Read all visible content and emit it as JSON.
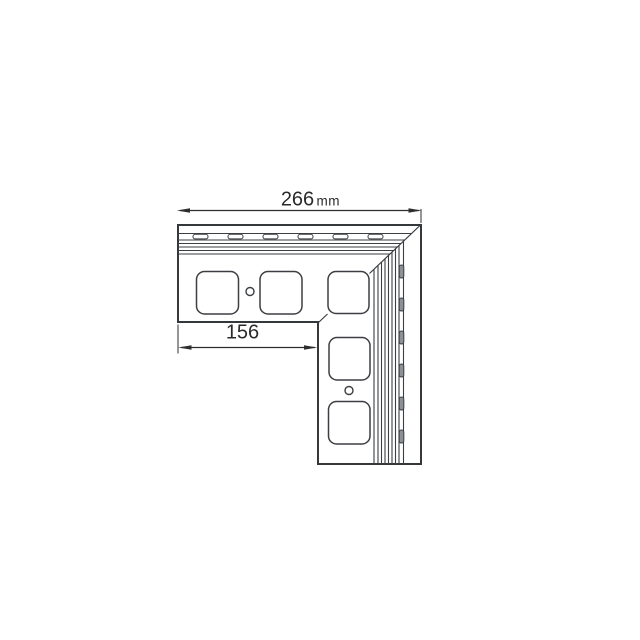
{
  "page": {
    "background_color": "#ffffff"
  },
  "drawing": {
    "type": "technical-line-drawing",
    "subject": "L-shaped corner trim profile, front view with mitre joint",
    "dimension_total": {
      "value": "266",
      "unit": "mm"
    },
    "dimension_partial": {
      "value": "156"
    },
    "colors": {
      "line": "#3b3e42",
      "outline": "#35383b",
      "slot_fill": "#8d9094",
      "face_fill": "#ffffff",
      "text": "#2a2a2a"
    },
    "features": {
      "square_cutouts": 5,
      "screw_holes": 2,
      "top_edge_slots": 6,
      "right_edge_slots": 6
    }
  }
}
